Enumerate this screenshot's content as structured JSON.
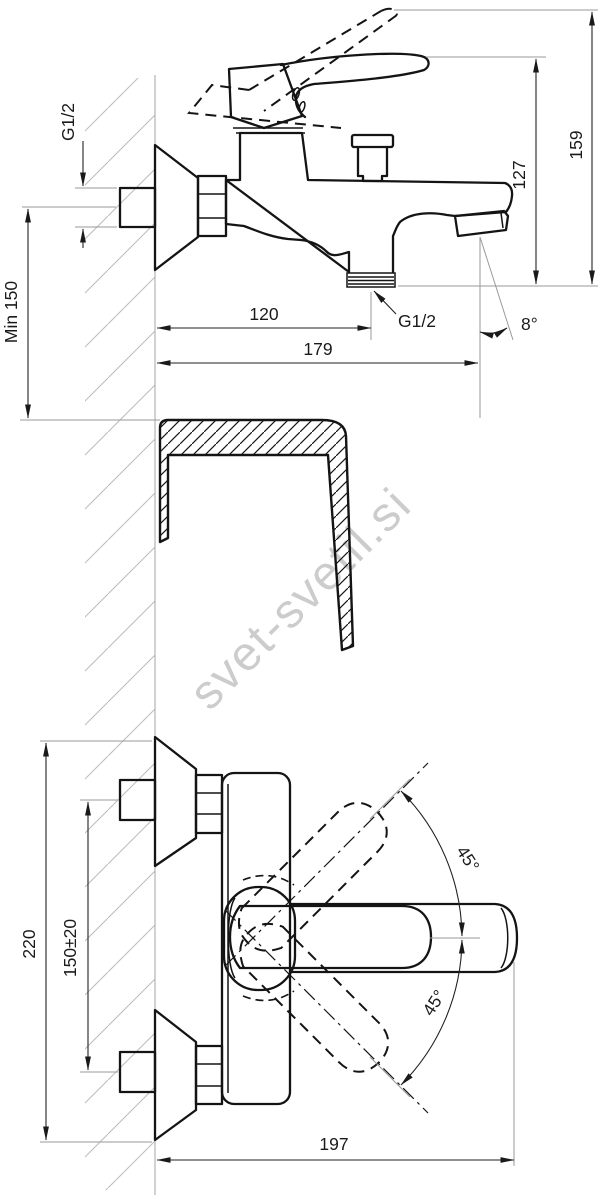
{
  "watermark": {
    "text": "svet-svetil.si"
  },
  "colors": {
    "ink": "#141414",
    "watermark": "#cccccc"
  },
  "side_view": {
    "thread_top": "G1/2",
    "min_wall_distance": "Min 150",
    "width_to_outlet": "120",
    "width_total": "179",
    "thread_bottom": "G1/2",
    "spout_angle": "8°",
    "height_body": "127",
    "height_total": "159"
  },
  "front_view": {
    "height_total": "220",
    "connection_spacing": "150±20",
    "handle_angle_up": "45°",
    "handle_angle_down": "45°",
    "length_total": "197"
  }
}
